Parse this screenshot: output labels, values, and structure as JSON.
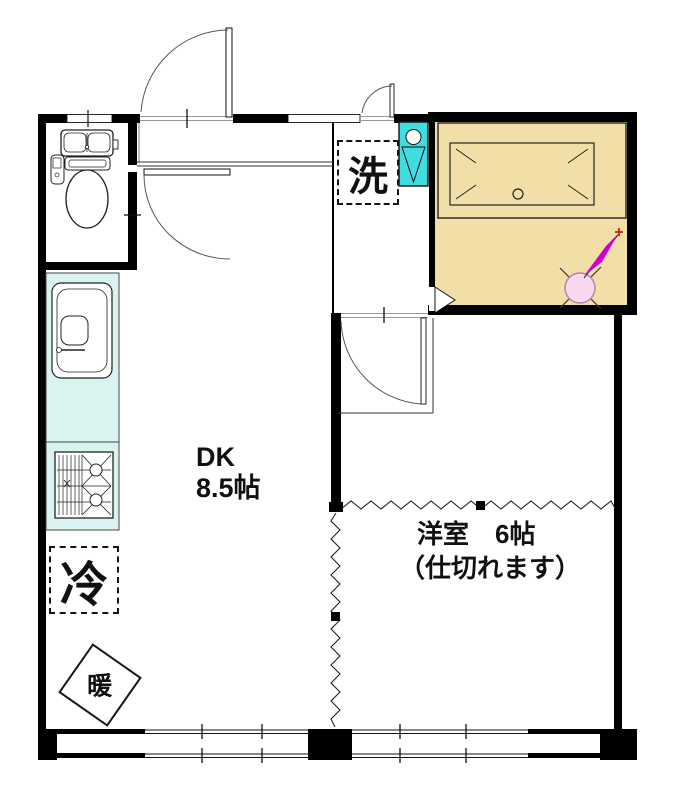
{
  "document": {
    "type": "japanese-apartment-floor-plan"
  },
  "labels": {
    "laundry": "洗",
    "dk_name": "DK",
    "dk_size": "8.5帖",
    "western_room_name": "洋室　6帖",
    "western_room_note": "（仕切れます）",
    "fridge": "冷",
    "heater": "暖"
  },
  "colors": {
    "wall": "#000000",
    "bathroom_floor": "#f2dfa8",
    "kitchen_counter": "#d9f4f0",
    "washbasin": "#3fdce0",
    "compass_circle_fill": "#f7d8ee",
    "compass_circle_stroke": "#b286a8",
    "compass_arrow": "#cc00cc",
    "compass_tip_star": "#cc2200"
  },
  "icons": {
    "toilet": "toilet-icon",
    "kitchen_sink": "kitchen-sink-icon",
    "gas_stove": "gas-stove-icon",
    "washbasin": "washbasin-icon",
    "bathtub": "bathtub-icon",
    "bath_door": "bath-folding-door-icon",
    "compass": "north-arrow-icon"
  }
}
